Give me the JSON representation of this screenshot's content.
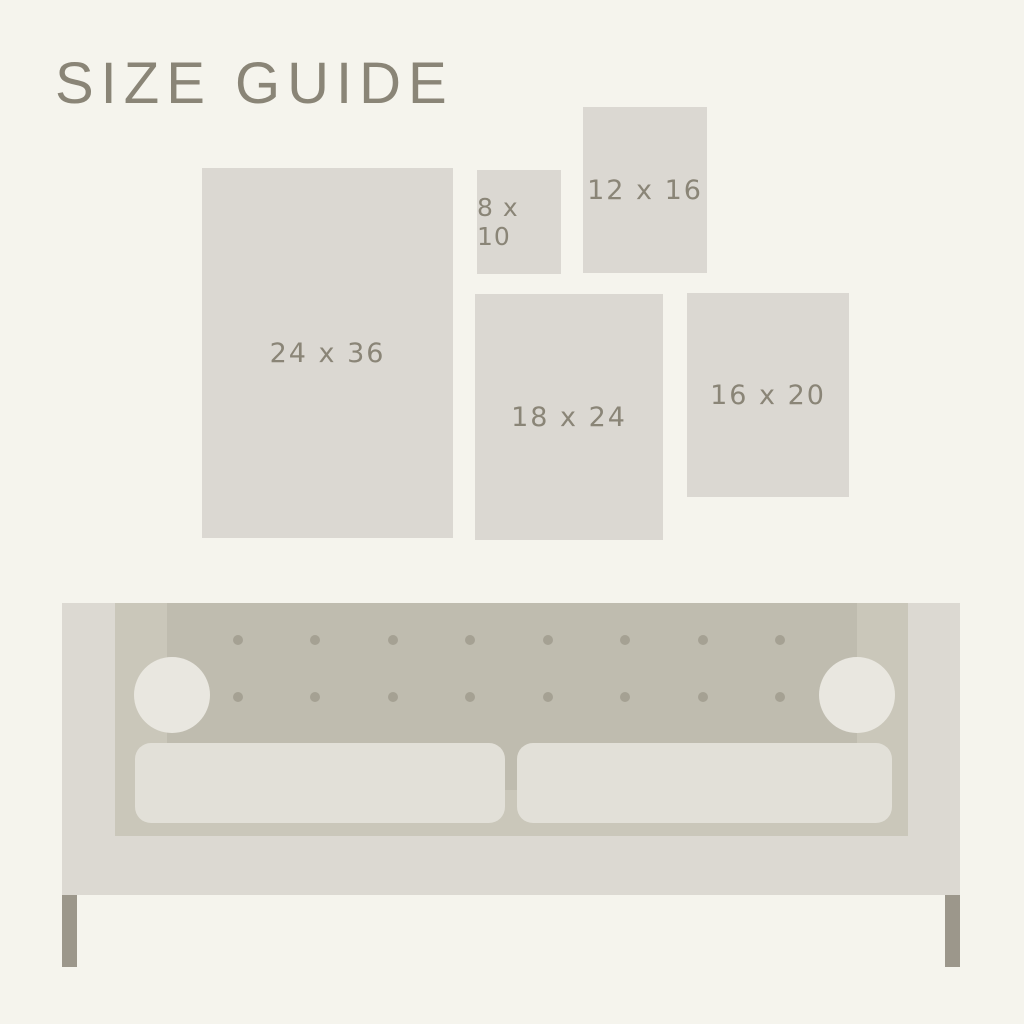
{
  "title": "SIZE GUIDE",
  "sizes": [
    {
      "id": "24x36",
      "label": "24 x 36"
    },
    {
      "id": "8x10",
      "label": "8 x 10"
    },
    {
      "id": "12x16",
      "label": "12 x 16"
    },
    {
      "id": "18x24",
      "label": "18 x 24"
    },
    {
      "id": "16x20",
      "label": "16 x 20"
    }
  ],
  "couch": {
    "tufting": {
      "rows": 2,
      "columns": 8
    },
    "cushions": 2,
    "bolsters": 2,
    "legs": 2
  },
  "colors": {
    "bg": "#f5f4ed",
    "swatch": "#dbd8d2",
    "text": "#8a8577",
    "sofa-body": "#dcd9d2",
    "sofa-panel": "#cac7ba",
    "sofa-tufted": "#bfbcaf",
    "sofa-button": "#a5a193",
    "sofa-bolster": "#e9e7e0",
    "sofa-cushion": "#e2e0d8",
    "sofa-leg": "#9c978b"
  }
}
